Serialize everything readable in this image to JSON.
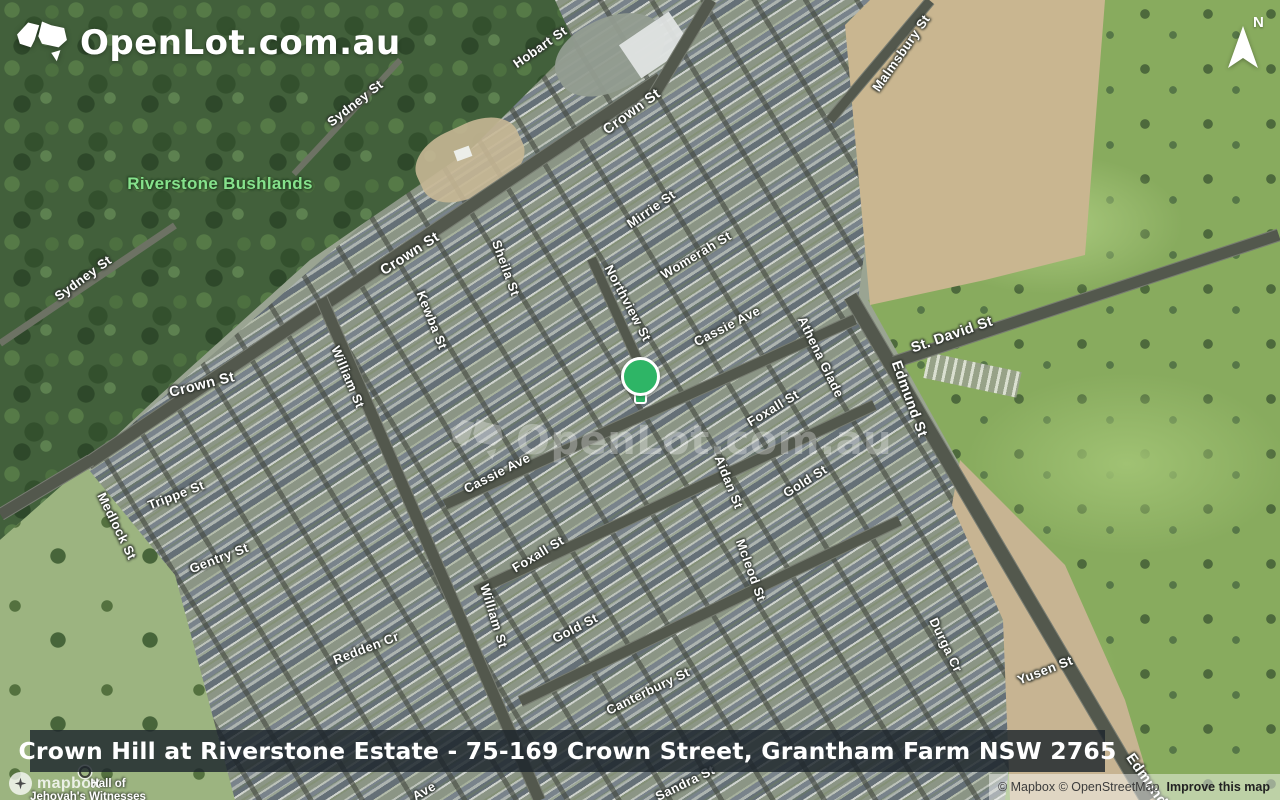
{
  "theme": {
    "marker_green": "#2eb566",
    "bushlands_label_green": "#86e28c",
    "banner_bg": "rgba(28,36,44,0.82)"
  },
  "header": {
    "logo_text": "OpenLot.com.au"
  },
  "compass": {
    "north_label": "N"
  },
  "watermark": {
    "text": "OpenLot.com.au"
  },
  "banner": {
    "text": "Crown Hill at Riverstone Estate - 75-169 Crown Street, Grantham Farm NSW 2765"
  },
  "attribution": {
    "wordmark": "mapbox",
    "copyrights": "© Mapbox © OpenStreetMap",
    "improve": "Improve this map"
  },
  "areas": {
    "bushlands": "Riverstone Bushlands"
  },
  "pois": {
    "hall_line1": "Hall of",
    "hall_line2": "Jehovah's Witnesses"
  },
  "streets": {
    "hobart": "Hobart St",
    "crown_top": "Crown St",
    "malmsbury": "Malmsbury St",
    "sydney_top": "Sydney St",
    "sydney_left": "Sydney St",
    "crown_mid": "Crown St",
    "crown_left": "Crown St",
    "sheila": "Sheila St",
    "kewba": "Kewba St",
    "mirrie": "Mirrie St",
    "womerah": "Womerah St",
    "northview": "Northview St",
    "cassie_upper": "Cassie Ave",
    "cassie_lower": "Cassie Ave",
    "athena": "Athena Glade",
    "st_david": "St. David St",
    "edmund": "Edmund St",
    "edmund_bottom": "Edmund St",
    "foxall_right": "Foxall St",
    "foxall_lower": "Foxall St",
    "aidan": "Aidan St",
    "gold_right": "Gold St",
    "gold_mid": "Gold St",
    "mcleod": "Mcleod St",
    "william_mid": "William St",
    "william_lower": "William St",
    "trippe": "Trippe St",
    "medlock": "Medlock St",
    "gentry": "Gentry St",
    "redden": "Redden Cr",
    "canterbury": "Canterbury St",
    "durga": "Durga Cr",
    "yusen": "Yusen St",
    "sandra": "Sandra St",
    "ave_partial": "Ave"
  }
}
